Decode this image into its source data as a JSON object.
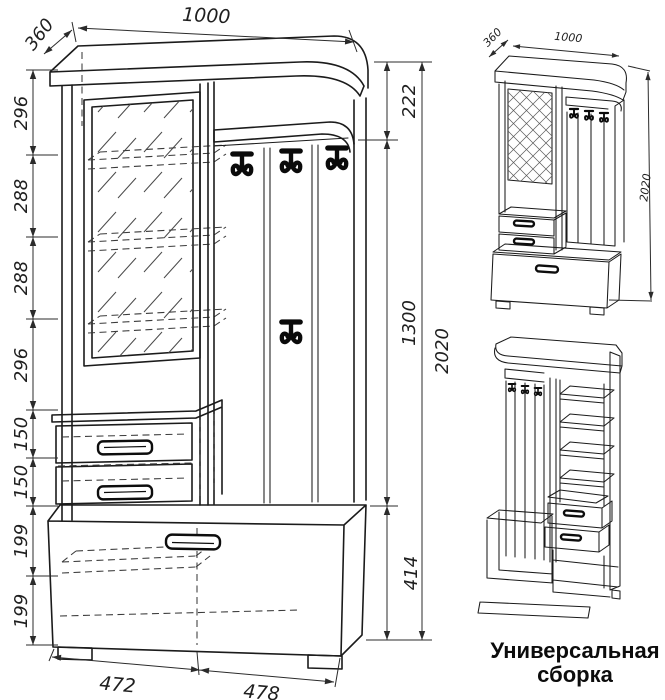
{
  "page": {
    "background": "#ffffff",
    "ink": "#1b1b1b"
  },
  "front_view": {
    "top_dims": {
      "depth": "360",
      "width": "1000"
    },
    "left_dims": [
      "296",
      "288",
      "288",
      "296",
      "150",
      "150",
      "199",
      "199"
    ],
    "right_dims": {
      "upper": "222",
      "middle": "1300",
      "lower": "414",
      "total": "2020"
    },
    "bottom_dims": [
      "472",
      "478"
    ]
  },
  "iso_view": {
    "depth": "360",
    "width": "1000",
    "height": "2020"
  },
  "caption": {
    "line1": "Универсальная",
    "line2": "сборка"
  }
}
